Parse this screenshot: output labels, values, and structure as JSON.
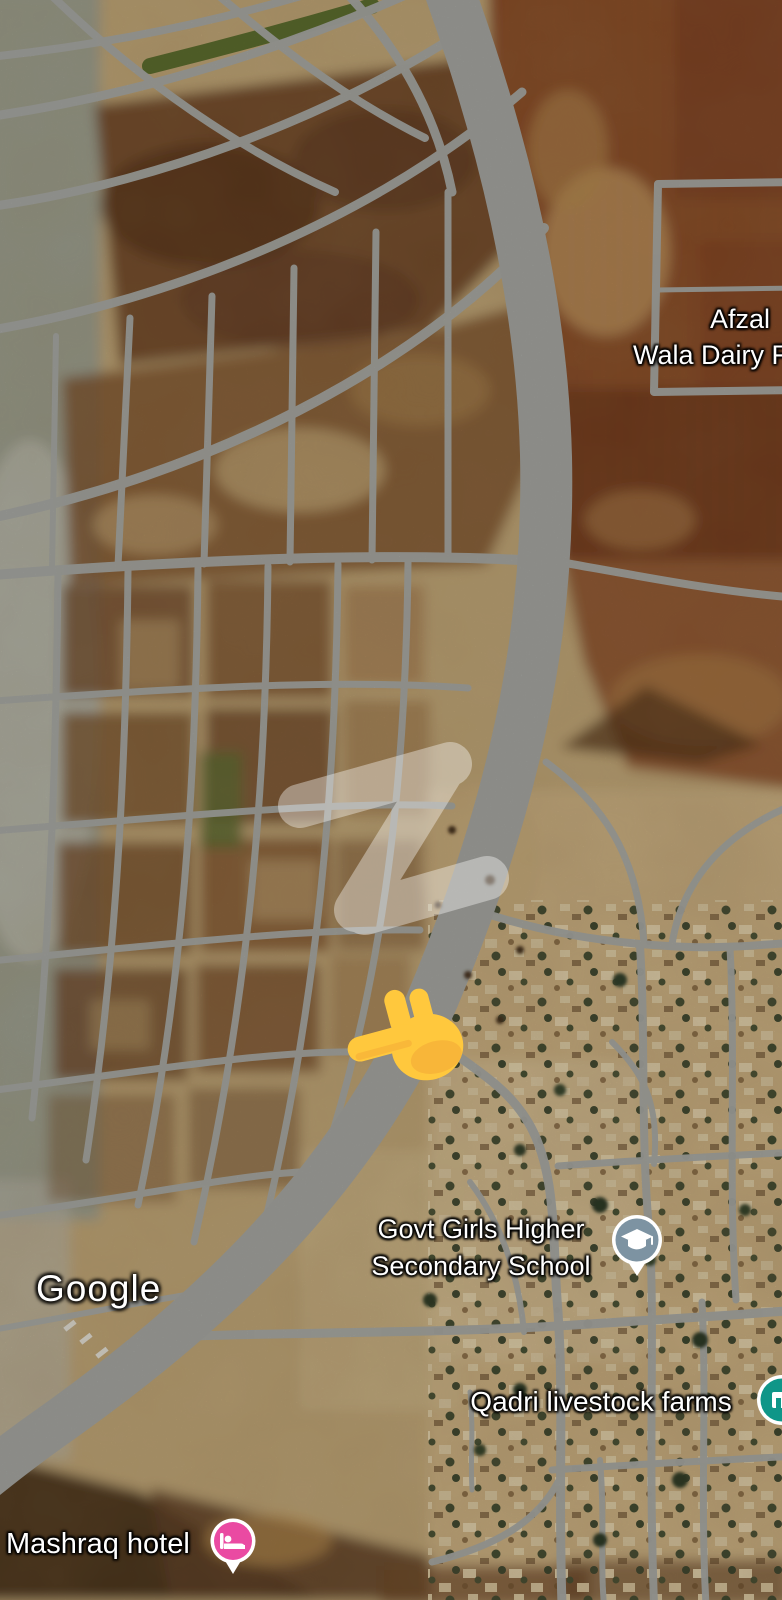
{
  "map": {
    "provider_logo": "Google",
    "labels": {
      "dairy_farm": {
        "line1": "Afzal",
        "line2": "Wala Dairy F"
      },
      "school": {
        "line1": "Govt Girls Higher",
        "line2": "Secondary School"
      },
      "livestock": {
        "text": "Qadri livestock farms"
      },
      "hotel": {
        "text": "Mashraq hotel"
      }
    },
    "icons": {
      "school": {
        "name": "graduation-cap-pin",
        "color": "#7D93A2"
      },
      "livestock": {
        "name": "storefront-pin",
        "color": "#0F9688"
      },
      "hotel": {
        "name": "bed-pin",
        "color": "#EA4AA2"
      },
      "pointer": {
        "name": "pointing-left-hand",
        "color": "#FFC83D"
      }
    },
    "watermark": {
      "name": "z-watermark",
      "color": "#FFFFFF",
      "opacity": 0.38
    },
    "terrain_colors": {
      "base_tan": "#C2A878",
      "scrub_brown": "#6A4123",
      "field_red_brown": "#8B4A25",
      "village_sand": "#CDB283",
      "road_gray": "#A7A8A3",
      "scrub_gray": "#99A094",
      "green_strip": "#5C6C2E"
    }
  }
}
